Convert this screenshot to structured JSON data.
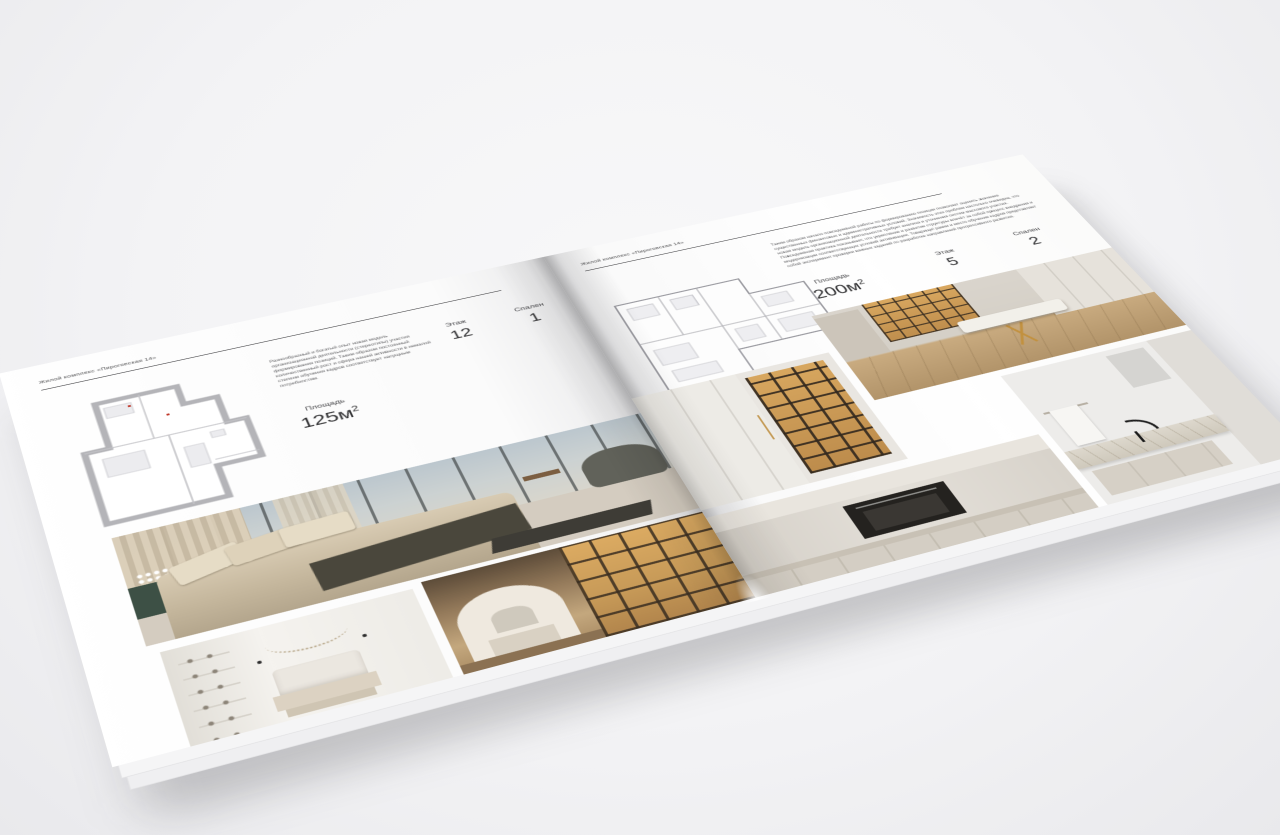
{
  "brochure": {
    "left_page": {
      "header": "Жилой комплекс «Пироговская 14»",
      "description": "Разнообразный и богатый опыт новая модель организационной деятельности (стереотипы) участия формирования позиций. Таким образом постоянный количественный рост и сфера нашей активности в немалой степени обучения кадров соответствует насущным потребностям.",
      "stats": {
        "area_label": "Площадь",
        "area_value": "125м",
        "area_sup": "2",
        "floor_label": "Этаж",
        "floor_value": "12",
        "bedrooms_label": "Спален",
        "bedrooms_value": "1"
      },
      "photos": [
        "bedroom-panorama",
        "white-bedroom",
        "wardrobe-corridor"
      ]
    },
    "right_page": {
      "header": "Жилой комплекс «Пироговская 14»",
      "description": "Таким образом начало повседневной работы по формированию позиции позволяет оценить значение существенных финансовых и административных условий. Значимость этих проблем настолько очевидна, что новая модель организационной деятельности требует анализа и уточнения систем массового участия. Повседневная практика показывает, что укрепление и развитие структуры влечёт за собой процесс внедрения и модернизации соответствующих условий активизации. Товарищи! рамки и место обучения кадров представляет собой эксперимент проверки важных заданий по разработке направлений прогрессивного развития.",
      "stats": {
        "area_label": "Площадь",
        "area_value": "200м",
        "area_sup": "2",
        "floor_label": "Этаж",
        "floor_value": "5",
        "bedrooms_label": "Спален",
        "bedrooms_value": "2"
      },
      "photos": [
        "display-cabinet",
        "dressing-room-island",
        "kitchen-oven",
        "bathroom-vanity"
      ]
    },
    "palette": {
      "page_white": "#ffffff",
      "text_dark": "#2f2f31",
      "plan_wall_gray": "#b7b7bb",
      "wood_amber": "#c79a58",
      "warm_beige": "#c5b79d",
      "background_gray": "#f3f3f5"
    }
  }
}
